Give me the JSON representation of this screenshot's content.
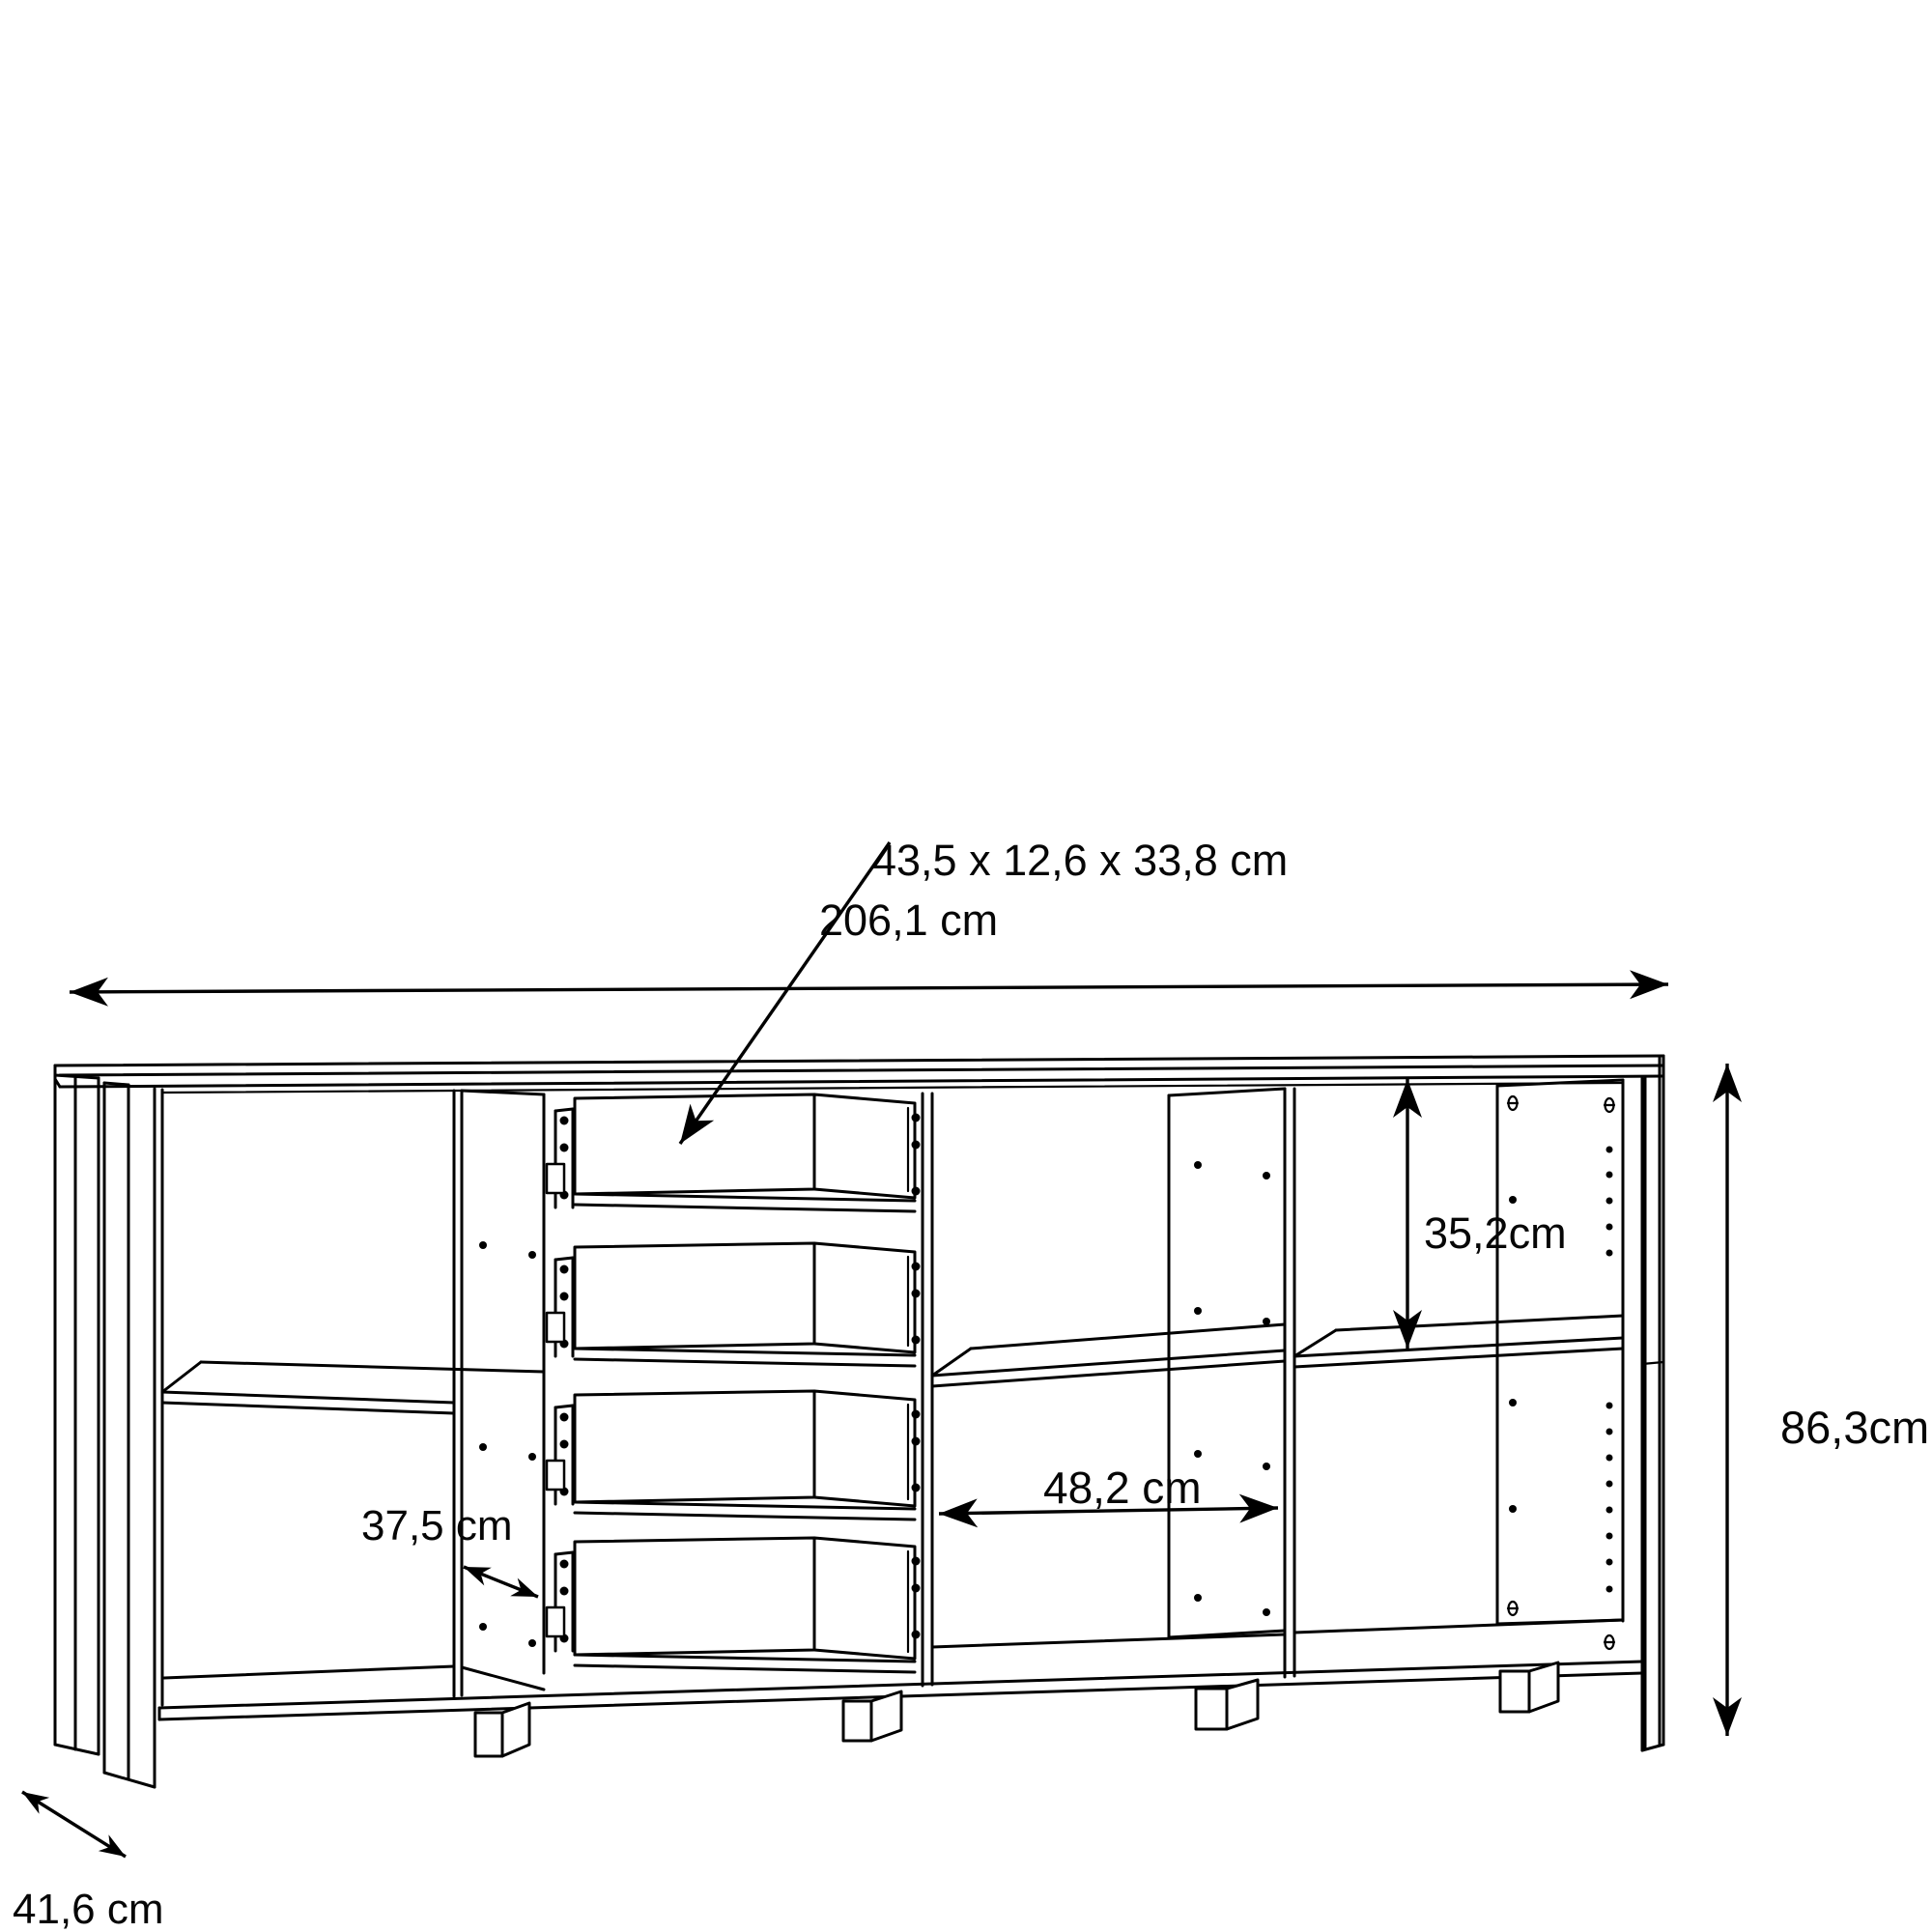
{
  "diagram": {
    "labels": {
      "drawer_inner_dimensions": "43,5 x 12,6 x 33,8 cm",
      "total_width": "206,1 cm",
      "right_compartment_height": "35,2cm",
      "total_height": "86,3cm",
      "middle_compartment_width": "48,2 cm",
      "left_compartment_width": "37,5 cm",
      "depth": "41,6 cm"
    },
    "colors": {
      "line": "#000000",
      "text": "#060606",
      "background": "#ffffff"
    }
  }
}
